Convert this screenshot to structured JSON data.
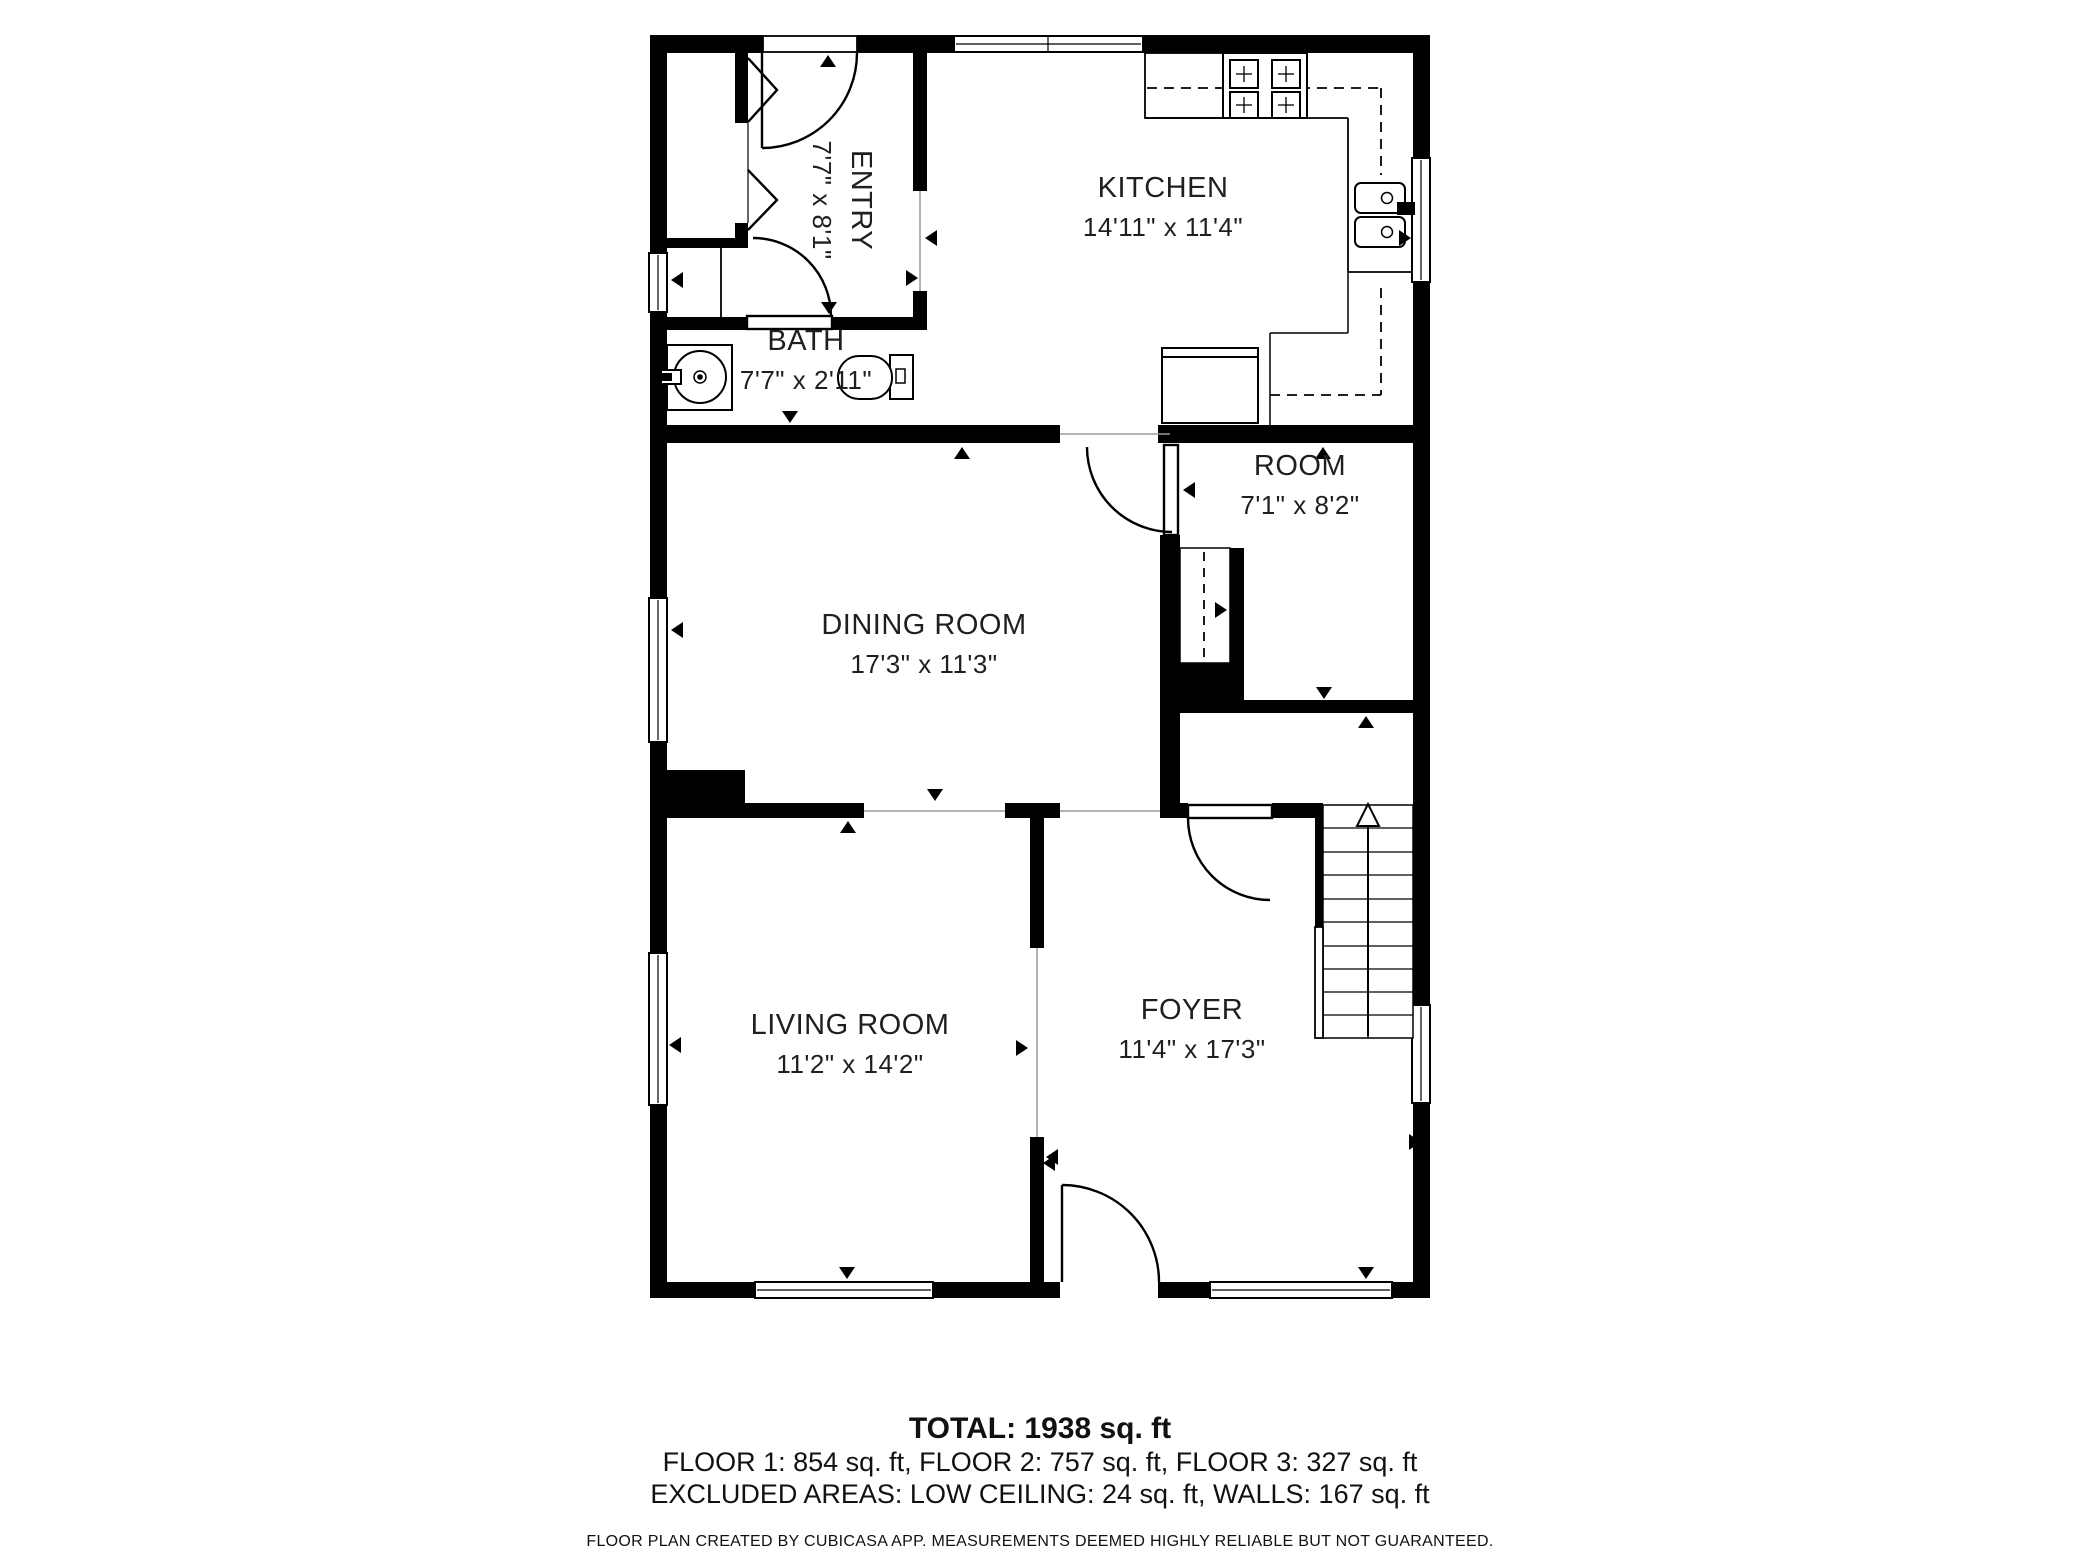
{
  "floorplan": {
    "rooms": [
      {
        "name": "ENTRY",
        "dims": "7'7\" x 8'1\""
      },
      {
        "name": "BATH",
        "dims": "7'7\" x 2'11\""
      },
      {
        "name": "KITCHEN",
        "dims": "14'11\" x 11'4\""
      },
      {
        "name": "ROOM",
        "dims": "7'1\" x 8'2\""
      },
      {
        "name": "DINING ROOM",
        "dims": "17'3\" x 11'3\""
      },
      {
        "name": "LIVING ROOM",
        "dims": "11'2\" x 14'2\""
      },
      {
        "name": "FOYER",
        "dims": "11'4\" x 17'3\""
      }
    ],
    "summary": {
      "total": "TOTAL: 1938 sq. ft",
      "floors": "FLOOR 1: 854 sq. ft, FLOOR 2: 757 sq. ft, FLOOR 3: 327 sq. ft",
      "excluded": "EXCLUDED AREAS: LOW CEILING: 24 sq. ft, WALLS: 167 sq. ft",
      "disclaimer": "FLOOR PLAN CREATED BY CUBICASA APP. MEASUREMENTS DEEMED HIGHLY RELIABLE BUT NOT GUARANTEED."
    },
    "colors": {
      "wall": "#000000",
      "text": "#1a1a1a",
      "background": "#ffffff"
    }
  }
}
